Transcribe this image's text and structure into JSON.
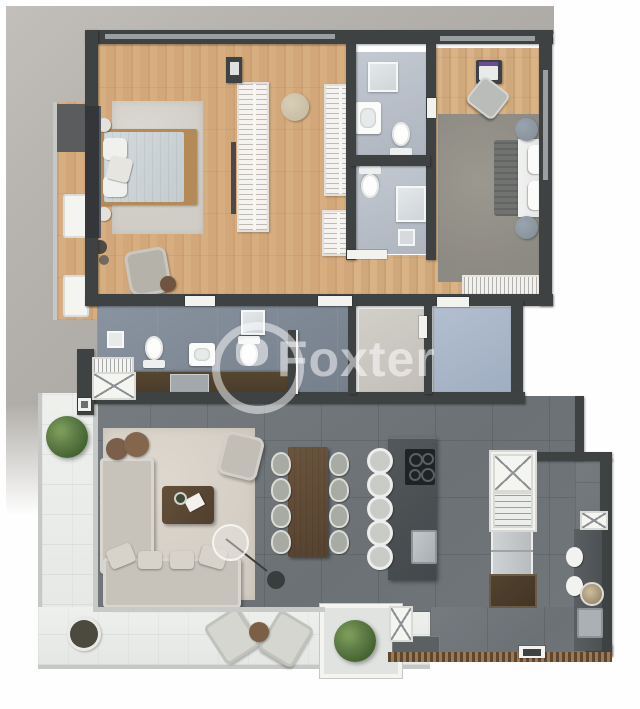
{
  "watermark": {
    "brand": "Foxter",
    "logo_icon": "foxter-ring-logo-icon"
  },
  "palette": {
    "exterior_concrete": "#b7b4af",
    "wall": "#3f4243",
    "wood_floor": "#d3ab7c",
    "bathroom_floor": "#b8bfc8",
    "hall_floor": "#7d8793",
    "living_floor": "#6f7579",
    "service_blue_floor": "#a9b6c8",
    "terrace_deck": "#e9ebe8",
    "living_rug": "#d8d2c8",
    "kitchen_island": "#474c4f",
    "dining_table_wood": "#5d4733",
    "plant_green": "#5d7c46",
    "watermark_white": "rgba(255,255,255,0.5)"
  },
  "scene": {
    "rooms": [
      "master-bedroom",
      "walk-in-closet",
      "side-balcony",
      "bathroom-1",
      "bathroom-2",
      "bedroom-2",
      "hallway",
      "powder-room",
      "service-room",
      "laundry-room",
      "elevator-shaft",
      "stair-shaft",
      "kitchen",
      "dining-area",
      "living-room",
      "terrace"
    ],
    "furniture_counts": {
      "beds": 2,
      "wardrobe_racks": 3,
      "toilets": 3,
      "showers": 3,
      "sinks": 4,
      "dining_chairs": 8,
      "kitchen_stools": 5,
      "lounge_chairs": 2,
      "plants": 3,
      "sofas": 1,
      "armchairs": 2,
      "coffee_tables": 1,
      "floor_lamps": 1,
      "elevators": 2
    }
  }
}
